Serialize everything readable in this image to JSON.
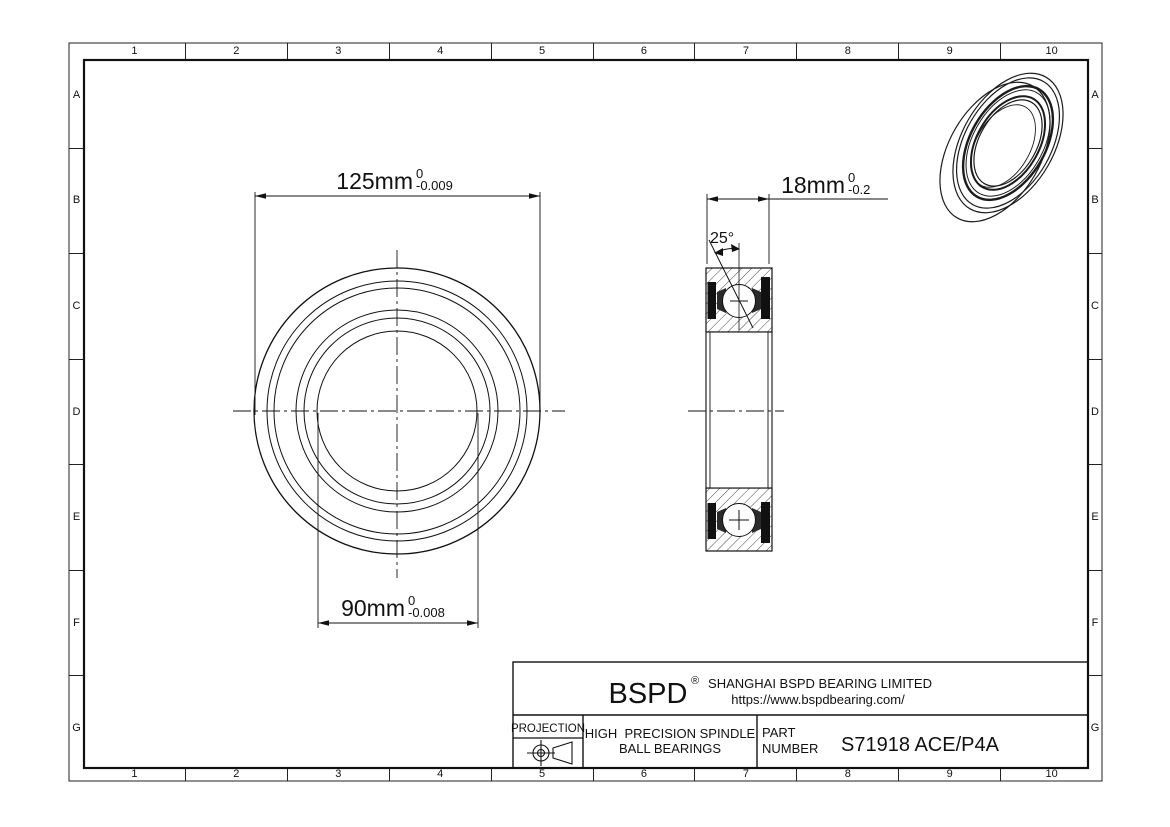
{
  "sheet": {
    "bg_color": "#ffffff",
    "line_color": "#111111"
  },
  "grid": {
    "cols": [
      "1",
      "2",
      "3",
      "4",
      "5",
      "6",
      "7",
      "8",
      "9",
      "10"
    ],
    "rows": [
      "A",
      "B",
      "C",
      "D",
      "E",
      "F",
      "G"
    ]
  },
  "front_view": {
    "dim_outer": {
      "value": "125mm",
      "tol_upper": "0",
      "tol_lower": "-0.009"
    },
    "dim_bore": {
      "value": "90mm",
      "tol_upper": "0",
      "tol_lower": "-0.008"
    }
  },
  "section_view": {
    "dim_width": {
      "value": "18mm",
      "tol_upper": "0",
      "tol_lower": "-0.2"
    },
    "contact_angle": "25°"
  },
  "title_block": {
    "logo": "BSPD",
    "logo_mark": "®",
    "company": "SHANGHAI BSPD BEARING LIMITED",
    "website": "https://www.bspdbearing.com/",
    "projection_label": "PROJECTION",
    "product_line1": "HIGH  PRECISION SPINDLE",
    "product_line2": "BALL BEARINGS",
    "part_label_line1": "PART",
    "part_label_line2": "NUMBER",
    "part_number": "S71918 ACE/P4A"
  }
}
